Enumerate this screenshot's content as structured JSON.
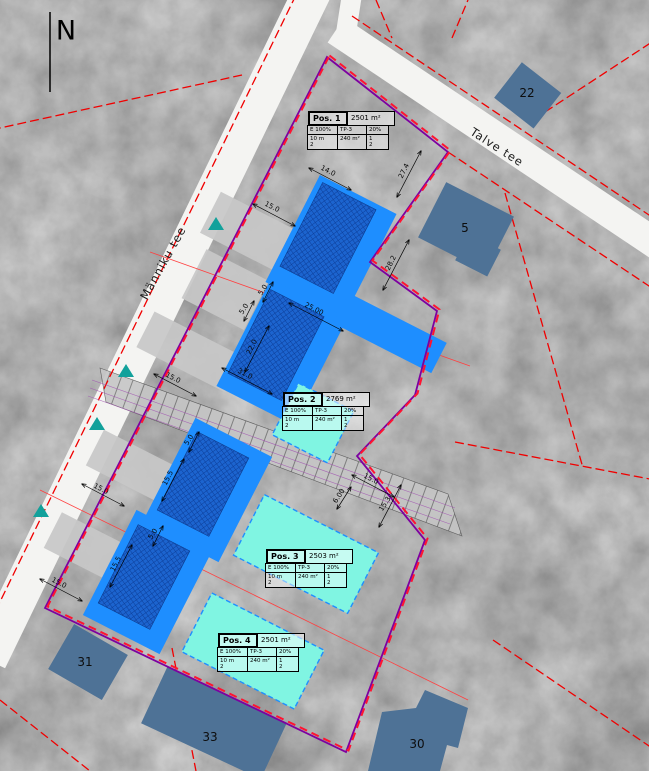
{
  "north_label": "N",
  "streets": {
    "manniku": "Männiku tee",
    "talve": "Talve tee"
  },
  "parcel_numbers": {
    "p22": "22",
    "p5": "5",
    "p31": "31",
    "p33": "33",
    "p30": "30"
  },
  "positions": [
    {
      "name": "Pos. 1",
      "area": "2501 m²",
      "e": "E 100%",
      "tp": "TP-3",
      "pct": "20%",
      "h_num": "10 m",
      "h_den": "2",
      "barea": "240 m²",
      "f_num": "1",
      "f_den": "2"
    },
    {
      "name": "Pos. 2",
      "area": "2769 m²",
      "e": "E 100%",
      "tp": "TP-3",
      "pct": "20%",
      "h_num": "10 m",
      "h_den": "2",
      "barea": "240 m²",
      "f_num": "1",
      "f_den": "2"
    },
    {
      "name": "Pos. 3",
      "area": "2503 m²",
      "e": "E 100%",
      "tp": "TP-3",
      "pct": "20%",
      "h_num": "10 m",
      "h_den": "2",
      "barea": "240 m²",
      "f_num": "1",
      "f_den": "2"
    },
    {
      "name": "Pos. 4",
      "area": "2501 m²",
      "e": "E 100%",
      "tp": "TP-3",
      "pct": "20%",
      "h_num": "10 m",
      "h_den": "2",
      "barea": "240 m²",
      "f_num": "1",
      "f_den": "2"
    }
  ],
  "dimensions": [
    {
      "t": "15.0"
    },
    {
      "t": "14.0"
    },
    {
      "t": "27.4"
    },
    {
      "t": "28.2"
    },
    {
      "t": "25.00"
    },
    {
      "t": "5.0"
    },
    {
      "t": "5.0"
    },
    {
      "t": "22.0"
    },
    {
      "t": "31.0"
    },
    {
      "t": "15.0"
    },
    {
      "t": "15.0"
    },
    {
      "t": "5.0"
    },
    {
      "t": "15.5"
    },
    {
      "t": "15.0"
    },
    {
      "t": "6.00"
    },
    {
      "t": "15.3"
    },
    {
      "t": "5.0"
    },
    {
      "t": "15.5"
    },
    {
      "t": "15.0"
    }
  ],
  "colors": {
    "planned_building_fill": "#1c64cf",
    "building_area_fill": "#1e8eff",
    "expansion_area_fill": "#80f5e2",
    "existing_building_fill": "#4e7296",
    "plan_boundary_purple": "#7d00a0",
    "plan_boundary_red": "#ff1430",
    "cadastral_line_red": "#f00000",
    "access_arrow_teal": "#12a19b",
    "road_fill": "#f4f4f2"
  }
}
